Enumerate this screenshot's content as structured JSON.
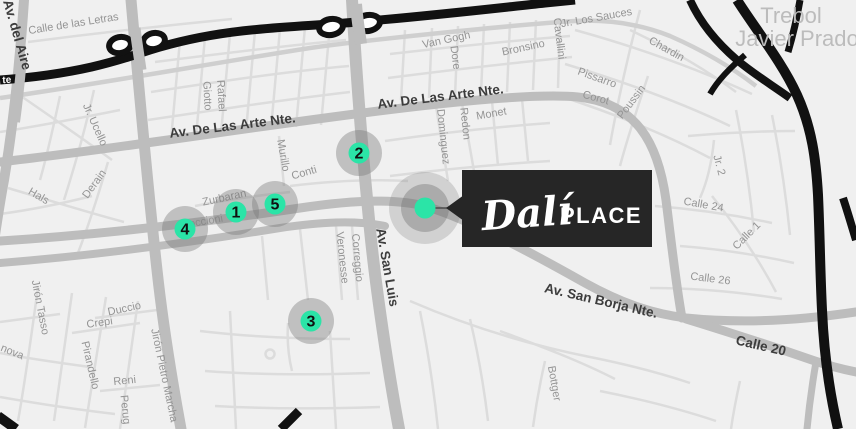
{
  "map": {
    "callout": {
      "title": "Dalí",
      "subtitle": "PLACE"
    },
    "main_marker": {
      "x": 425,
      "y": 208
    },
    "markers": [
      {
        "label": "1",
        "x": 236,
        "y": 212
      },
      {
        "label": "2",
        "x": 359,
        "y": 153
      },
      {
        "label": "3",
        "x": 311,
        "y": 321
      },
      {
        "label": "4",
        "x": 185,
        "y": 229
      },
      {
        "label": "5",
        "x": 275,
        "y": 204
      }
    ],
    "labels": [
      {
        "text": "Calle de las Letras",
        "x": 74,
        "y": 27,
        "rot": -9,
        "cls": "minor"
      },
      {
        "text": "Av. del Aire",
        "x": 13,
        "y": 36,
        "rot": 74,
        "cls": "avenue"
      },
      {
        "text": "te",
        "x": 7,
        "y": 83,
        "rot": -3,
        "cls": "onblack"
      },
      {
        "text": "Giotto",
        "x": 204,
        "y": 96,
        "rot": 87,
        "cls": "minor"
      },
      {
        "text": "Rafael",
        "x": 218,
        "y": 96,
        "rot": 87,
        "cls": "minor"
      },
      {
        "text": "Jr. Ucello",
        "x": 92,
        "y": 126,
        "rot": 66,
        "cls": "minor"
      },
      {
        "text": "Av. De Las Arte Nte.",
        "x": 233,
        "y": 130,
        "rot": -7,
        "cls": "avenue"
      },
      {
        "text": "Av. De Las Arte Nte.",
        "x": 441,
        "y": 101,
        "rot": -7,
        "cls": "avenue"
      },
      {
        "text": "Van Gogh",
        "x": 447,
        "y": 43,
        "rot": -12,
        "cls": "minor"
      },
      {
        "text": "Dore",
        "x": 452,
        "y": 58,
        "rot": 82,
        "cls": "minor"
      },
      {
        "text": "Bronsino",
        "x": 524,
        "y": 51,
        "rot": -12,
        "cls": "minor"
      },
      {
        "text": "Cavallini",
        "x": 556,
        "y": 39,
        "rot": 83,
        "cls": "minor"
      },
      {
        "text": "Jr. Los Sauces",
        "x": 597,
        "y": 21,
        "rot": -10,
        "cls": "minor"
      },
      {
        "text": "Chardin",
        "x": 665,
        "y": 52,
        "rot": 29,
        "cls": "minor"
      },
      {
        "text": "Pissarro",
        "x": 596,
        "y": 81,
        "rot": 20,
        "cls": "minor"
      },
      {
        "text": "Corot",
        "x": 595,
        "y": 101,
        "rot": 15,
        "cls": "minor"
      },
      {
        "text": "Poussin",
        "x": 634,
        "y": 104,
        "rot": -53,
        "cls": "minor"
      },
      {
        "text": "Trebol",
        "x": 791,
        "y": 23,
        "rot": 0,
        "cls": "district"
      },
      {
        "text": "Javier Prado",
        "x": 797,
        "y": 46,
        "rot": 0,
        "cls": "district"
      },
      {
        "text": "Jr. 2",
        "x": 716,
        "y": 166,
        "rot": 75,
        "cls": "minor"
      },
      {
        "text": "Calle 24",
        "x": 703,
        "y": 208,
        "rot": 10,
        "cls": "minor"
      },
      {
        "text": "Calle 1",
        "x": 749,
        "y": 238,
        "rot": -45,
        "cls": "minor"
      },
      {
        "text": "Calle 26",
        "x": 710,
        "y": 282,
        "rot": 7,
        "cls": "minor"
      },
      {
        "text": "Hals",
        "x": 37,
        "y": 199,
        "rot": 30,
        "cls": "minor"
      },
      {
        "text": "Derain",
        "x": 97,
        "y": 186,
        "rot": -54,
        "cls": "minor"
      },
      {
        "text": "Zurbaran",
        "x": 225,
        "y": 201,
        "rot": -12,
        "cls": "minor"
      },
      {
        "text": "Boccioni",
        "x": 203,
        "y": 225,
        "rot": -10,
        "cls": "minor"
      },
      {
        "text": "Murillo",
        "x": 280,
        "y": 156,
        "rot": 80,
        "cls": "minor"
      },
      {
        "text": "Conti",
        "x": 305,
        "y": 176,
        "rot": -16,
        "cls": "minor"
      },
      {
        "text": "Veronesse",
        "x": 339,
        "y": 258,
        "rot": 84,
        "cls": "minor"
      },
      {
        "text": "Correggio",
        "x": 354,
        "y": 258,
        "rot": 85,
        "cls": "minor"
      },
      {
        "text": "Av. San Luis",
        "x": 383,
        "y": 268,
        "rot": 80,
        "cls": "avenue"
      },
      {
        "text": "Dominguez",
        "x": 440,
        "y": 137,
        "rot": 84,
        "cls": "minor"
      },
      {
        "text": "Redon",
        "x": 462,
        "y": 124,
        "rot": 84,
        "cls": "minor"
      },
      {
        "text": "Monet",
        "x": 492,
        "y": 117,
        "rot": -10,
        "cls": "minor"
      },
      {
        "text": "Jirón Tasso",
        "x": 37,
        "y": 308,
        "rot": 79,
        "cls": "minor"
      },
      {
        "text": "nova",
        "x": 11,
        "y": 355,
        "rot": 22,
        "cls": "minor"
      },
      {
        "text": "Duccio",
        "x": 125,
        "y": 312,
        "rot": -12,
        "cls": "minor"
      },
      {
        "text": "Crepi",
        "x": 100,
        "y": 326,
        "rot": -8,
        "cls": "minor"
      },
      {
        "text": "Pirandello",
        "x": 87,
        "y": 366,
        "rot": 77,
        "cls": "minor"
      },
      {
        "text": "Reni",
        "x": 125,
        "y": 384,
        "rot": -6,
        "cls": "minor"
      },
      {
        "text": "Perug",
        "x": 122,
        "y": 410,
        "rot": 84,
        "cls": "minor"
      },
      {
        "text": "Jirón Pietro Marcha",
        "x": 161,
        "y": 376,
        "rot": 78,
        "cls": "minor"
      },
      {
        "text": "Av. San Borja Nte.",
        "x": 600,
        "y": 305,
        "rot": 13,
        "cls": "avenue"
      },
      {
        "text": "Calle 20",
        "x": 760,
        "y": 350,
        "rot": 13,
        "cls": "avenue"
      },
      {
        "text": "Bottger",
        "x": 551,
        "y": 384,
        "rot": 80,
        "cls": "minor"
      }
    ],
    "colors": {
      "accent": "#2BE4A7",
      "callout_bg": "#262626",
      "highway": "#111111",
      "road_major": "#bdbdbd",
      "road_medium": "#cfcfcf",
      "road_minor": "#dcdcdc",
      "background": "#f0f0f0",
      "halo": "rgba(120,120,120,0.40)"
    }
  }
}
